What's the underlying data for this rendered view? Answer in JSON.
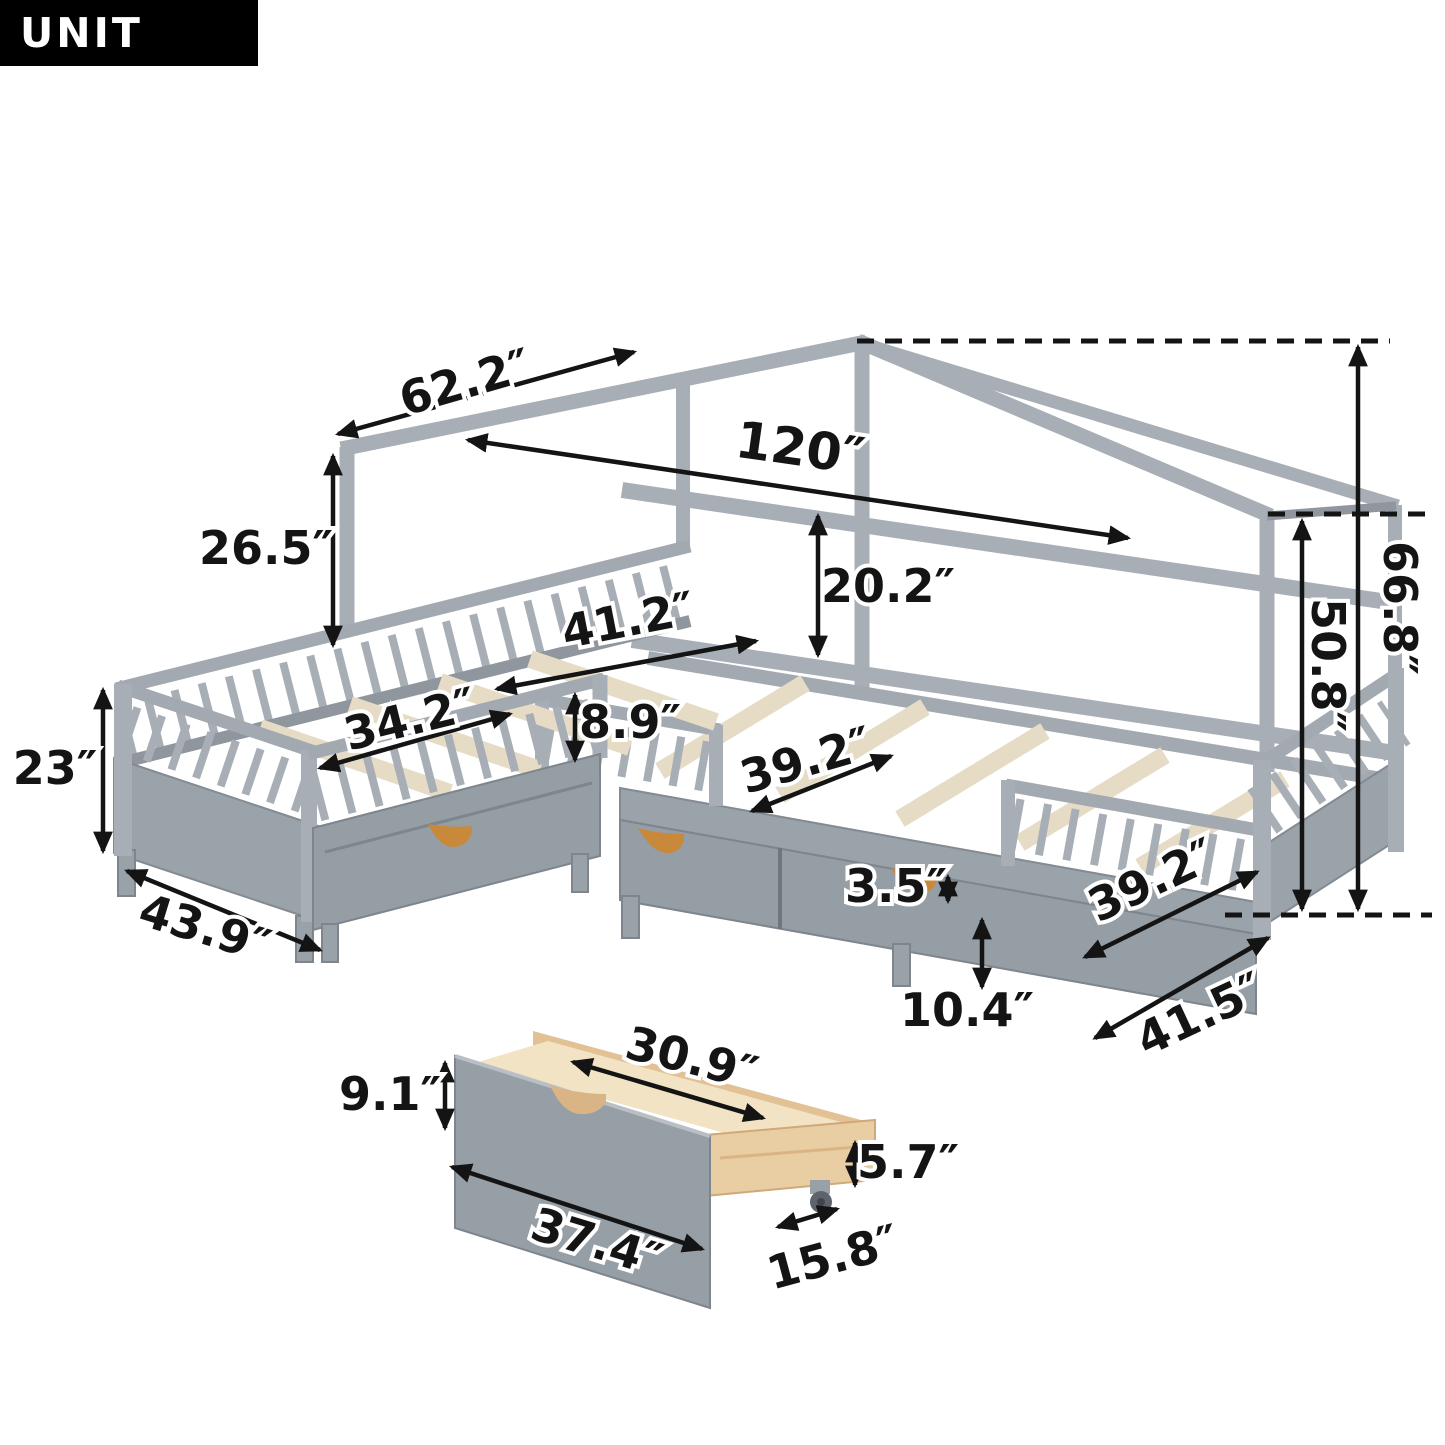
{
  "unit_badge": {
    "label": "UNIT INCH"
  },
  "colors": {
    "badge_bg": "#000000",
    "badge_text": "#ffffff",
    "frame_gray": "#a8aeb5",
    "panel_gray": "#9aa2aa",
    "slat_cream": "#e6dcc6",
    "drawer_wood": "#e9cda3",
    "handle_orange": "#c8893b",
    "annotation_black": "#141414"
  },
  "bed_diagram": {
    "dimensions": [
      {
        "id": "roof-slope",
        "text": "62.2″"
      },
      {
        "id": "overall-length",
        "text": "120″"
      },
      {
        "id": "eave-post-height",
        "text": "26.5″"
      },
      {
        "id": "wall-rail-gap",
        "text": "20.2″"
      },
      {
        "id": "left-bed-length-outer",
        "text": "41.2″"
      },
      {
        "id": "left-bed-length-inner",
        "text": "34.2″"
      },
      {
        "id": "guardrail-height",
        "text": "8.9″"
      },
      {
        "id": "footboard-height",
        "text": "23″"
      },
      {
        "id": "left-bed-width-outer",
        "text": "43.9″"
      },
      {
        "id": "slat-length",
        "text": "39.2″"
      },
      {
        "id": "slat-to-drawer-gap",
        "text": "3.5″"
      },
      {
        "id": "underbed-clearance",
        "text": "10.4″"
      },
      {
        "id": "right-footboard-width",
        "text": "39.2″"
      },
      {
        "id": "right-bed-width-outer",
        "text": "41.5″"
      },
      {
        "id": "floor-to-eave-height",
        "text": "50.8″"
      },
      {
        "id": "floor-to-peak-height",
        "text": "66.8″"
      }
    ]
  },
  "drawer_diagram": {
    "dimensions": [
      {
        "id": "front-height",
        "text": "9.1″"
      },
      {
        "id": "inner-length",
        "text": "30.9″"
      },
      {
        "id": "front-length",
        "text": "37.4″"
      },
      {
        "id": "depth",
        "text": "15.8″"
      },
      {
        "id": "box-height",
        "text": "5.7″"
      }
    ]
  }
}
